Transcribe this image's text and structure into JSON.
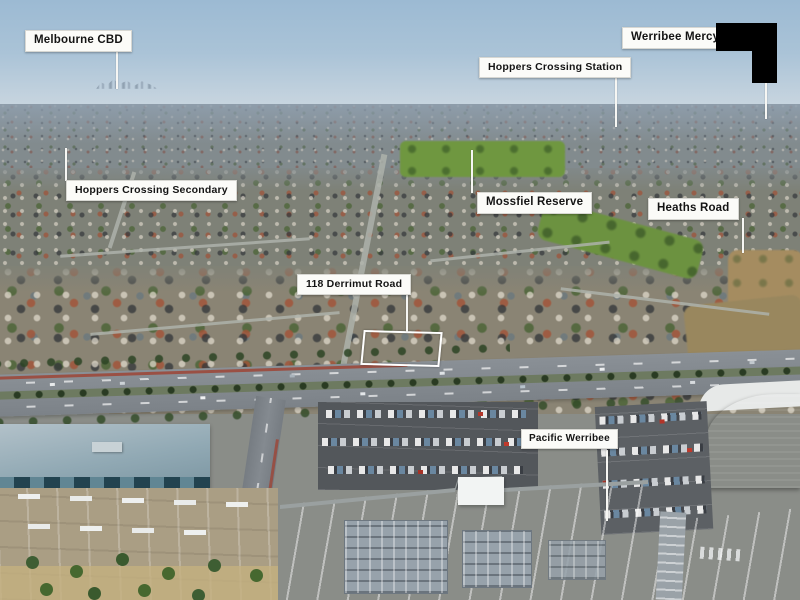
{
  "image_type": "annotated aerial photograph (real-estate marketing, Hoppers Crossing / Werribee VIC)",
  "annotation_style": {
    "label_background": "#fbfbf8",
    "label_text_color": "#141414",
    "leader_line_color": "#f6f6f3",
    "redaction_color": "#000000",
    "property_outline_color": "#ffffff"
  },
  "labels": {
    "melbourne_cbd": "Melbourne CBD",
    "werribee_mercy": "Werribee Mercy",
    "hoppers_crossing_station": "Hoppers Crossing Station",
    "hoppers_crossing_secondary": "Hoppers Crossing Secondary",
    "mossfiel_reserve": "Mossfiel Reserve",
    "heaths_road": "Heaths Road",
    "property": "118 Derrimut Road",
    "pacific_werribee": "Pacific Werribee"
  }
}
